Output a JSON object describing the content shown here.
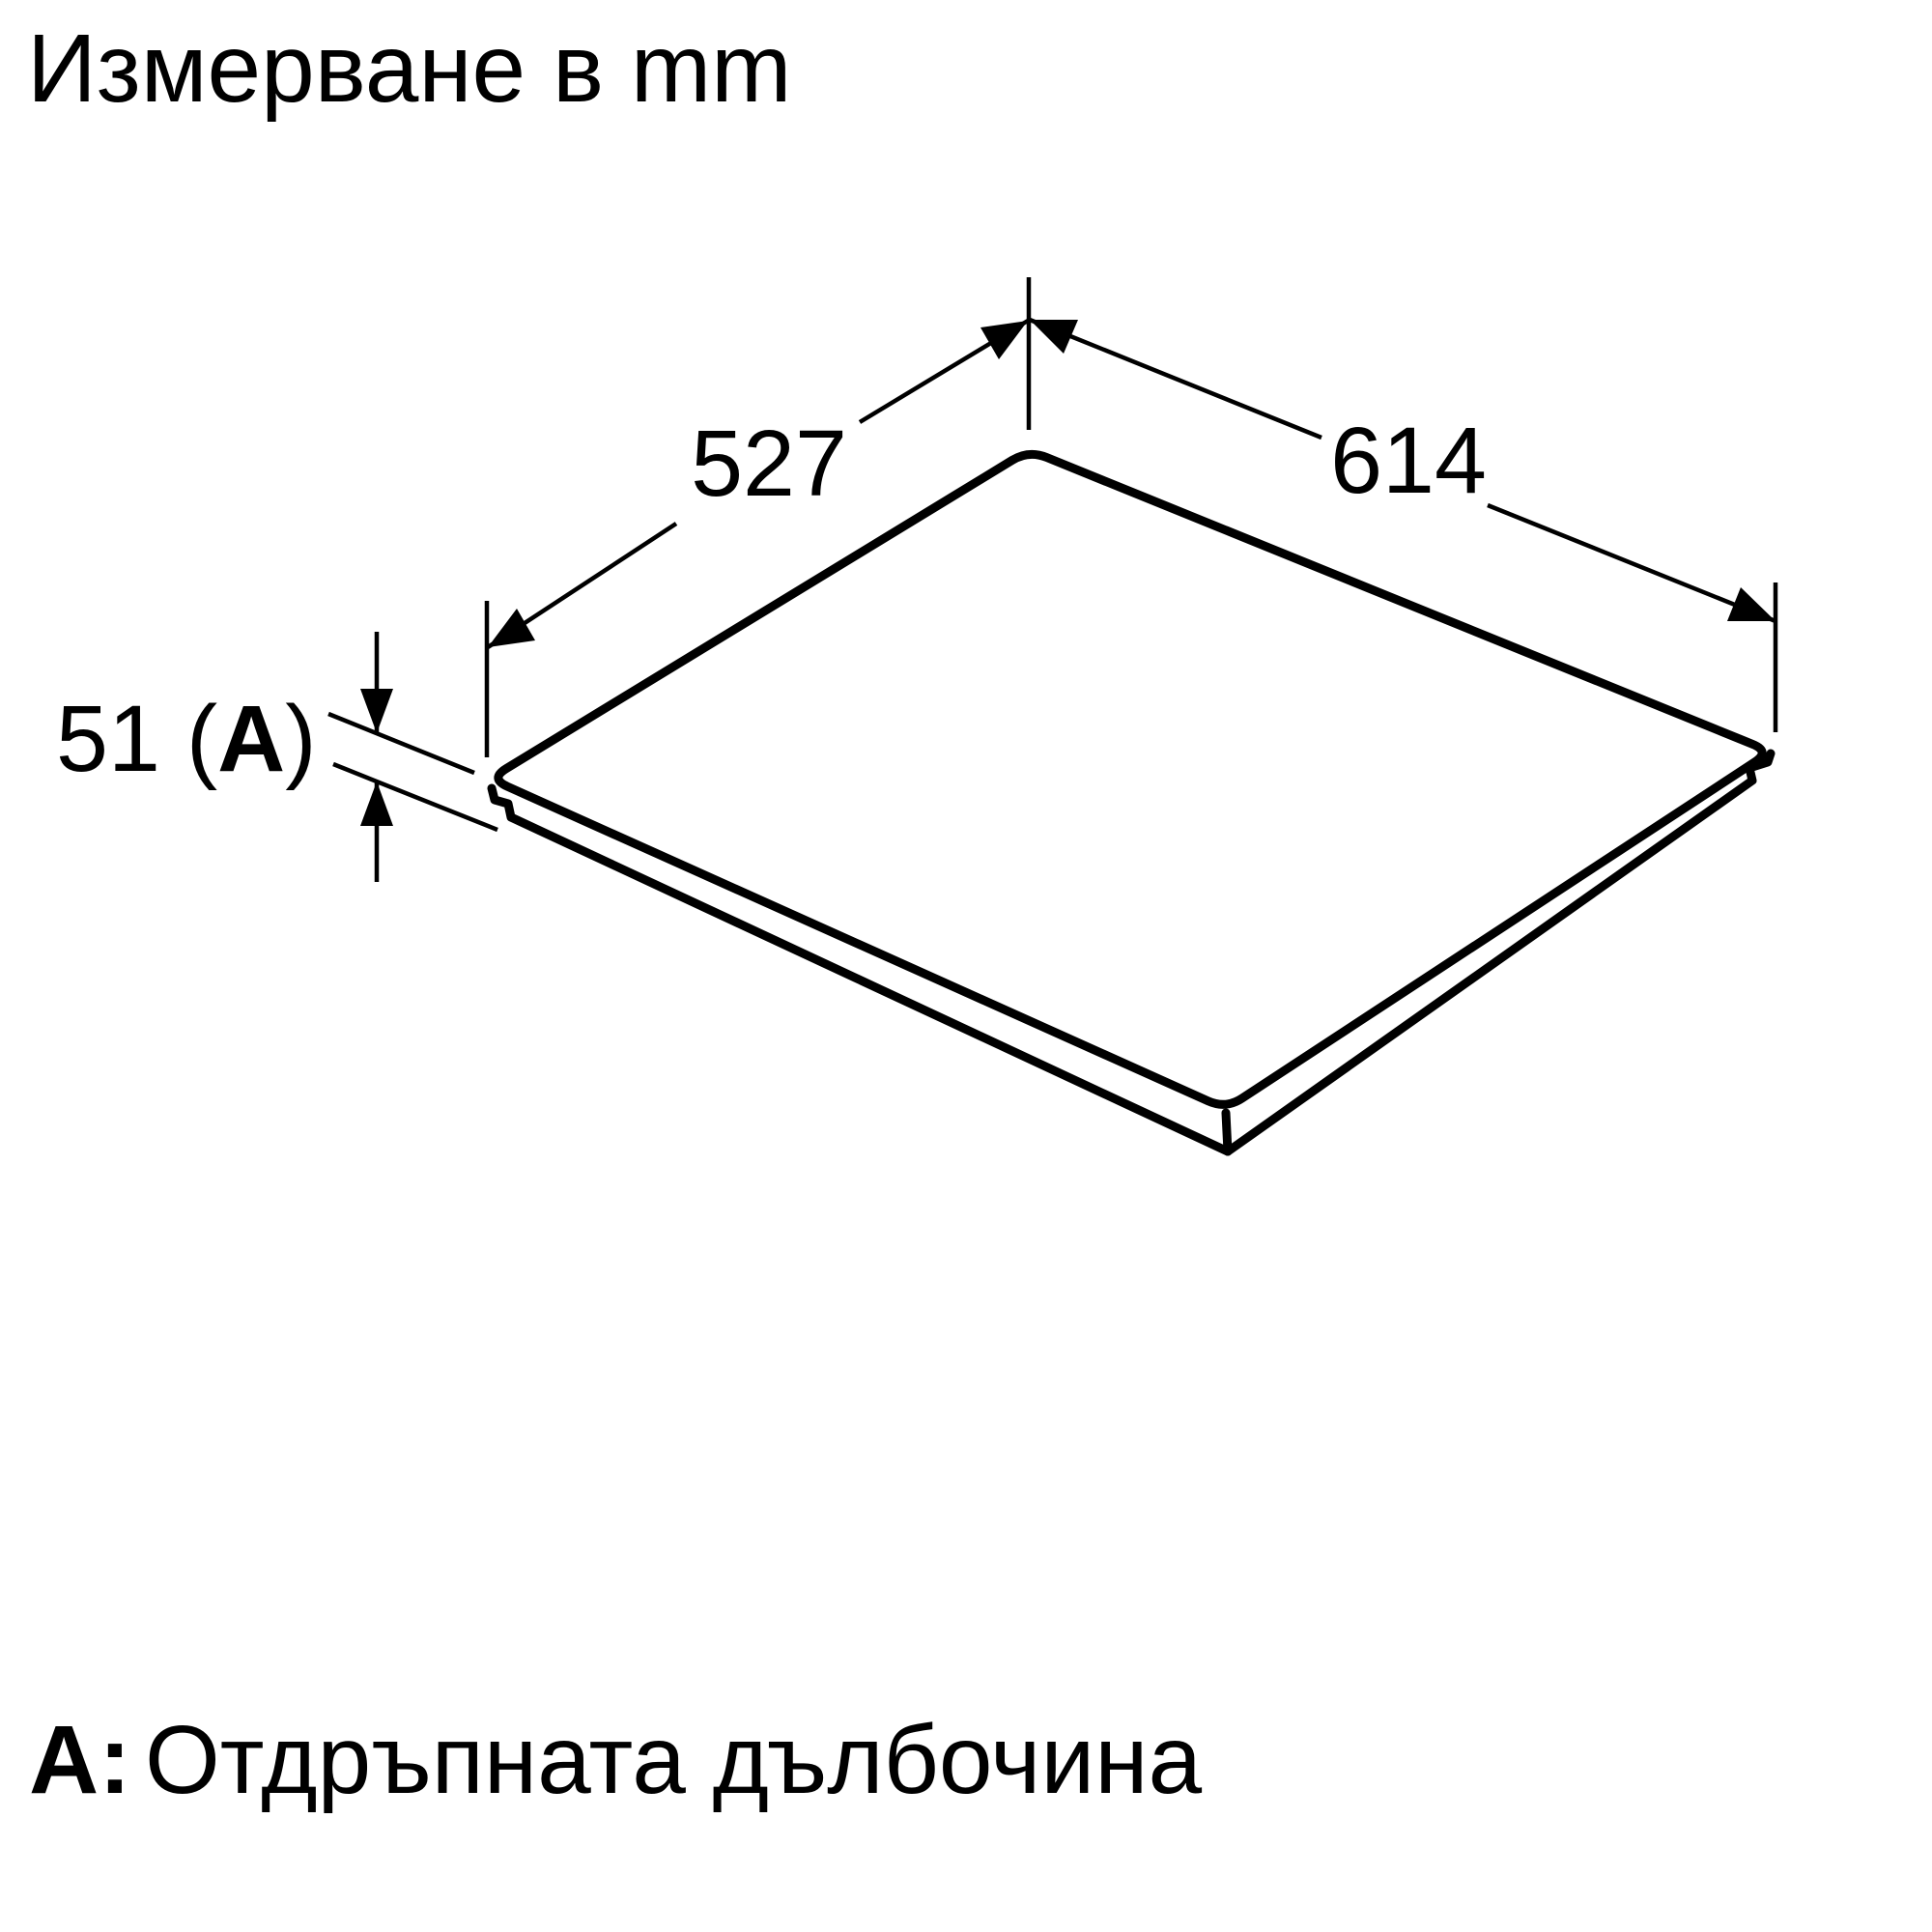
{
  "colors": {
    "ink": "#000000",
    "background": "#ffffff"
  },
  "header": {
    "title": "Измерване в mm"
  },
  "diagram": {
    "unit_note": "mm",
    "dim_back_edge": "527",
    "dim_front_edge": "614",
    "dim_recess_prefix": "51 (",
    "dim_recess_key": "A",
    "dim_recess_suffix": ")"
  },
  "legend": {
    "key": "A:",
    "text": "Отдръпната дълбочина"
  }
}
